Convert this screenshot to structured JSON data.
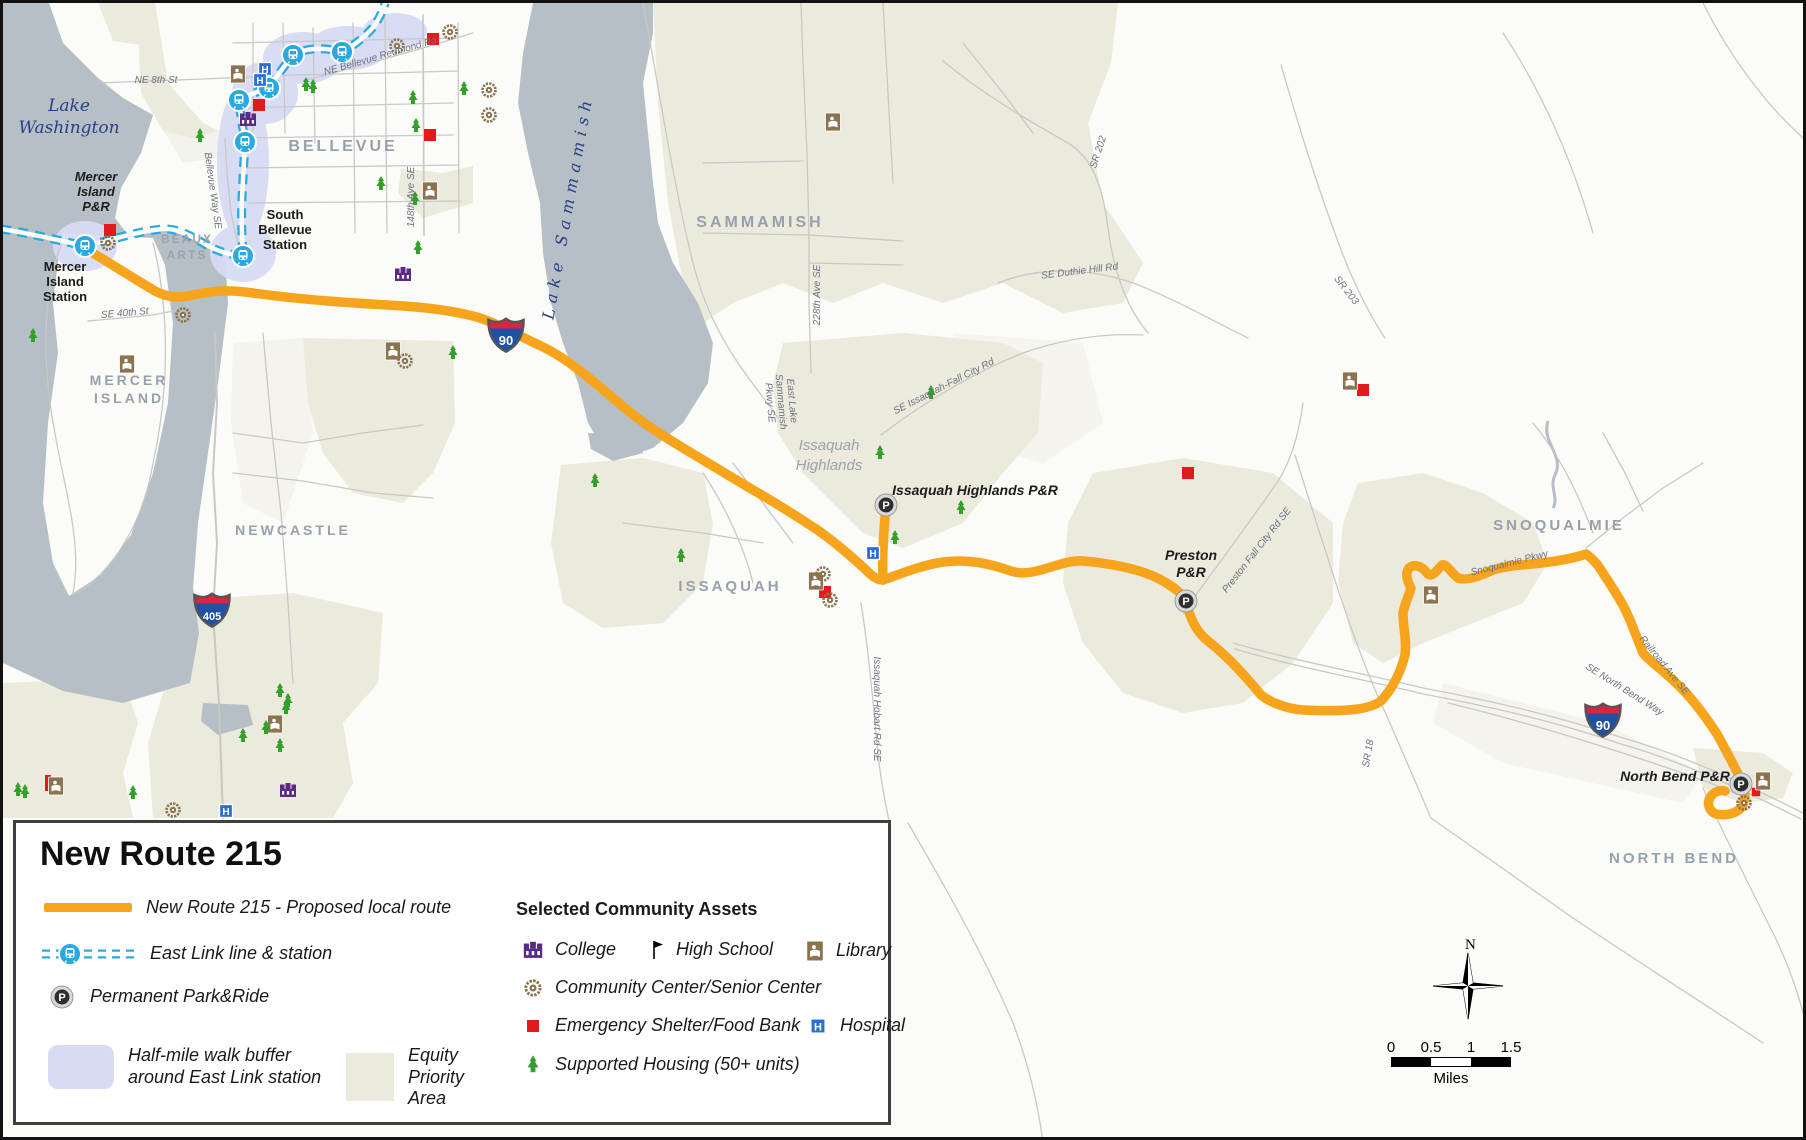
{
  "legend": {
    "title": "New Route 215",
    "route_label": "New Route 215 - Proposed local route",
    "eastlink_label": "East Link line & station",
    "parkride_label": "Permanent Park&Ride",
    "buffer_label": "Half-mile walk buffer\naround East Link station",
    "equity_label": "Equity\nPriority\nArea",
    "assets_header": "Selected Community Assets",
    "college_label": "College",
    "highschool_label": "High School",
    "library_label": "Library",
    "commcenter_label": "Community Center/Senior Center",
    "shelter_label": "Emergency Shelter/Food Bank",
    "hospital_label": "Hospital",
    "housing_label": "Supported Housing (50+ units)"
  },
  "scalebar": {
    "ticks": [
      "0",
      "0.5",
      "1",
      "1.5"
    ],
    "unit": "Miles",
    "north": "N"
  },
  "map": {
    "colors": {
      "route": "#f7a41d",
      "eastlink": "#2aa8e0",
      "water": "#b5bfc5",
      "equity": "#eceadd",
      "buffer": "#d7dbf4",
      "road": "#c8c8c4",
      "land": "#fbfbf8",
      "shield_blue": "#2051a3",
      "shield_red": "#d7263d",
      "shelter": "#e31a1c",
      "library": "#8a7450",
      "college": "#5b2a86",
      "hospital": "#2a6fd6",
      "housing": "#33a02c",
      "pnr_dark": "#2e2e2e"
    },
    "labels": [
      {
        "t": [
          "Lake",
          "Washington"
        ],
        "x": 66,
        "y": 108,
        "cls": "water",
        "fs": 17,
        "lh": 22
      },
      {
        "t": [
          "Lake Sammamish"
        ],
        "x": 570,
        "y": 205,
        "cls": "water",
        "fs": 16,
        "rot": -80,
        "ls": 6
      },
      {
        "t": [
          "BELLEVUE"
        ],
        "x": 340,
        "y": 148,
        "cls": "city",
        "fs": 16
      },
      {
        "t": [
          "SAMMAMISH"
        ],
        "x": 757,
        "y": 224,
        "cls": "city",
        "fs": 16
      },
      {
        "t": [
          "MERCER",
          "ISLAND"
        ],
        "x": 126,
        "y": 382,
        "cls": "city",
        "fs": 14,
        "lh": 18,
        "ls": 2
      },
      {
        "t": [
          "NEWCASTLE"
        ],
        "x": 290,
        "y": 532,
        "cls": "city",
        "fs": 14,
        "ls": 2
      },
      {
        "t": [
          "ISSAQUAH"
        ],
        "x": 727,
        "y": 588,
        "cls": "city",
        "fs": 15,
        "ls": 2
      },
      {
        "t": [
          "SNOQUALMIE"
        ],
        "x": 1556,
        "y": 527,
        "cls": "city",
        "fs": 15
      },
      {
        "t": [
          "NORTH BEND"
        ],
        "x": 1671,
        "y": 860,
        "cls": "city",
        "fs": 15,
        "ls": 2
      },
      {
        "t": [
          "BEAUX",
          "ARTS"
        ],
        "x": 184,
        "y": 240,
        "cls": "city-sm",
        "fs": 12,
        "lh": 16
      },
      {
        "t": [
          "Issaquah",
          "Highlands"
        ],
        "x": 826,
        "y": 447,
        "cls": "hl",
        "fs": 15,
        "lh": 20
      },
      {
        "t": [
          "Mercer",
          "Island",
          "P&R"
        ],
        "x": 93,
        "y": 178,
        "cls": "pnr",
        "fs": 13,
        "lh": 15
      },
      {
        "t": [
          "Mercer",
          "Island",
          "Station"
        ],
        "x": 62,
        "y": 268,
        "cls": "station",
        "fs": 13,
        "lh": 15
      },
      {
        "t": [
          "South",
          "Bellevue",
          "Station"
        ],
        "x": 282,
        "y": 216,
        "cls": "station",
        "fs": 13,
        "lh": 15
      },
      {
        "t": [
          "Issaquah Highlands P&R"
        ],
        "x": 972,
        "y": 492,
        "cls": "pnr",
        "fs": 14
      },
      {
        "t": [
          "Preston",
          "P&R"
        ],
        "x": 1188,
        "y": 557,
        "cls": "pnr",
        "fs": 14,
        "lh": 17
      },
      {
        "t": [
          "North Bend P&R"
        ],
        "x": 1672,
        "y": 778,
        "cls": "pnr",
        "fs": 14
      },
      {
        "t": [
          "NE 8th St"
        ],
        "x": 153,
        "y": 80,
        "cls": "road",
        "fs": 10
      },
      {
        "t": [
          "NE Bellevue Redmond Rd"
        ],
        "x": 378,
        "y": 56,
        "cls": "road",
        "fs": 10,
        "rot": -16
      },
      {
        "t": [
          "Bellevue Way SE"
        ],
        "x": 207,
        "y": 188,
        "cls": "road",
        "fs": 10,
        "rot": 82
      },
      {
        "t": [
          "148th Ave SE"
        ],
        "x": 411,
        "y": 194,
        "cls": "road",
        "fs": 10,
        "rot": -90
      },
      {
        "t": [
          "SE 40th St"
        ],
        "x": 122,
        "y": 313,
        "cls": "road",
        "fs": 10,
        "rot": -5
      },
      {
        "t": [
          "228th Ave SE"
        ],
        "x": 817,
        "y": 292,
        "cls": "road",
        "fs": 10,
        "rot": -90
      },
      {
        "t": [
          "SE Duthie Hill Rd"
        ],
        "x": 1077,
        "y": 271,
        "cls": "road",
        "fs": 10,
        "rot": -7
      },
      {
        "t": [
          "SR 202"
        ],
        "x": 1098,
        "y": 150,
        "cls": "road",
        "fs": 10,
        "rot": -72
      },
      {
        "t": [
          "SR 203"
        ],
        "x": 1341,
        "y": 289,
        "cls": "road",
        "fs": 10,
        "rot": 52
      },
      {
        "t": [
          "East Lake",
          "Sammamish",
          "Pkwy SE"
        ],
        "x": 786,
        "y": 398,
        "cls": "road",
        "fs": 10,
        "rot": 85,
        "lh": 11
      },
      {
        "t": [
          "SE Issaquah-Fall City Rd"
        ],
        "x": 942,
        "y": 386,
        "cls": "road",
        "fs": 10,
        "rot": -27
      },
      {
        "t": [
          "Issaquah Hobart Rd SE"
        ],
        "x": 871,
        "y": 706,
        "cls": "road",
        "fs": 10,
        "rot": 90
      },
      {
        "t": [
          "Preston Fall City Rd SE"
        ],
        "x": 1256,
        "y": 549,
        "cls": "road",
        "fs": 10,
        "rot": -52
      },
      {
        "t": [
          "SR 18"
        ],
        "x": 1368,
        "y": 751,
        "cls": "road",
        "fs": 10,
        "rot": -80
      },
      {
        "t": [
          "Snoqualmie Pkwy"
        ],
        "x": 1507,
        "y": 563,
        "cls": "road",
        "fs": 10,
        "rot": -14
      },
      {
        "t": [
          "Railroad Ave SE"
        ],
        "x": 1659,
        "y": 664,
        "cls": "road",
        "fs": 10,
        "rot": 51
      },
      {
        "t": [
          "SE North Bend Way"
        ],
        "x": 1620,
        "y": 689,
        "cls": "road",
        "fs": 10,
        "rot": 32
      }
    ],
    "shields": [
      {
        "num": "90",
        "x": 503,
        "y": 332
      },
      {
        "num": "90",
        "x": 1600,
        "y": 717
      },
      {
        "num": "405",
        "x": 209,
        "y": 607
      }
    ],
    "icons": [
      {
        "type": "station",
        "x": 82,
        "y": 243
      },
      {
        "type": "station",
        "x": 240,
        "y": 253
      },
      {
        "type": "station",
        "x": 242,
        "y": 139
      },
      {
        "type": "station",
        "x": 236,
        "y": 97
      },
      {
        "type": "station",
        "x": 266,
        "y": 85
      },
      {
        "type": "station",
        "x": 290,
        "y": 52
      },
      {
        "type": "station",
        "x": 339,
        "y": 49
      },
      {
        "type": "parkride",
        "x": 883,
        "y": 502
      },
      {
        "type": "parkride",
        "x": 1183,
        "y": 598
      },
      {
        "type": "parkride",
        "x": 1738,
        "y": 781
      },
      {
        "type": "hospital",
        "x": 262,
        "y": 66
      },
      {
        "type": "hospital",
        "x": 257,
        "y": 77
      },
      {
        "type": "hospital",
        "x": 870,
        "y": 550
      },
      {
        "type": "hospital",
        "x": 223,
        "y": 808
      },
      {
        "type": "shelter",
        "x": 107,
        "y": 227
      },
      {
        "type": "shelter",
        "x": 256,
        "y": 102
      },
      {
        "type": "shelter",
        "x": 430,
        "y": 36
      },
      {
        "type": "shelter",
        "x": 427,
        "y": 132
      },
      {
        "type": "shelter",
        "x": 822,
        "y": 589
      },
      {
        "type": "shelter",
        "x": 1185,
        "y": 470
      },
      {
        "type": "shelter",
        "x": 1360,
        "y": 387
      },
      {
        "type": "shelterv",
        "x": 45,
        "y": 780
      },
      {
        "type": "shelter",
        "x": 1753,
        "y": 789,
        "s": 0.7
      },
      {
        "type": "library",
        "x": 235,
        "y": 71
      },
      {
        "type": "library",
        "x": 427,
        "y": 188
      },
      {
        "type": "library",
        "x": 830,
        "y": 119
      },
      {
        "type": "library",
        "x": 124,
        "y": 361
      },
      {
        "type": "library",
        "x": 390,
        "y": 348
      },
      {
        "type": "library",
        "x": 272,
        "y": 721
      },
      {
        "type": "library",
        "x": 53,
        "y": 783
      },
      {
        "type": "library",
        "x": 813,
        "y": 578
      },
      {
        "type": "library",
        "x": 1347,
        "y": 378
      },
      {
        "type": "library",
        "x": 1428,
        "y": 592
      },
      {
        "type": "library",
        "x": 1760,
        "y": 778
      },
      {
        "type": "college",
        "x": 245,
        "y": 117
      },
      {
        "type": "college",
        "x": 400,
        "y": 272
      },
      {
        "type": "college",
        "x": 285,
        "y": 788
      },
      {
        "type": "commcenter",
        "x": 105,
        "y": 240
      },
      {
        "type": "commcenter",
        "x": 394,
        "y": 43
      },
      {
        "type": "commcenter",
        "x": 447,
        "y": 29
      },
      {
        "type": "commcenter",
        "x": 486,
        "y": 87
      },
      {
        "type": "commcenter",
        "x": 486,
        "y": 112
      },
      {
        "type": "commcenter",
        "x": 402,
        "y": 358
      },
      {
        "type": "commcenter",
        "x": 180,
        "y": 312
      },
      {
        "type": "commcenter",
        "x": 170,
        "y": 807
      },
      {
        "type": "commcenter",
        "x": 820,
        "y": 571
      },
      {
        "type": "commcenter",
        "x": 827,
        "y": 597
      },
      {
        "type": "commcenter",
        "x": 1741,
        "y": 800
      },
      {
        "type": "housing",
        "x": 197,
        "y": 133
      },
      {
        "type": "housing",
        "x": 303,
        "y": 82
      },
      {
        "type": "housing",
        "x": 310,
        "y": 84
      },
      {
        "type": "housing",
        "x": 410,
        "y": 95
      },
      {
        "type": "housing",
        "x": 413,
        "y": 123
      },
      {
        "type": "housing",
        "x": 461,
        "y": 86
      },
      {
        "type": "housing",
        "x": 415,
        "y": 245
      },
      {
        "type": "housing",
        "x": 450,
        "y": 350
      },
      {
        "type": "housing",
        "x": 378,
        "y": 181
      },
      {
        "type": "housing",
        "x": 412,
        "y": 196
      },
      {
        "type": "housing",
        "x": 592,
        "y": 478
      },
      {
        "type": "housing",
        "x": 678,
        "y": 553
      },
      {
        "type": "housing",
        "x": 877,
        "y": 450
      },
      {
        "type": "housing",
        "x": 928,
        "y": 390
      },
      {
        "type": "housing",
        "x": 958,
        "y": 505
      },
      {
        "type": "housing",
        "x": 892,
        "y": 535
      },
      {
        "type": "housing",
        "x": 240,
        "y": 733
      },
      {
        "type": "housing",
        "x": 263,
        "y": 725
      },
      {
        "type": "housing",
        "x": 277,
        "y": 688
      },
      {
        "type": "housing",
        "x": 285,
        "y": 698
      },
      {
        "type": "housing",
        "x": 283,
        "y": 705
      },
      {
        "type": "housing",
        "x": 277,
        "y": 743
      },
      {
        "type": "housing",
        "x": 130,
        "y": 790
      },
      {
        "type": "housing",
        "x": 15,
        "y": 787
      },
      {
        "type": "housing",
        "x": 22,
        "y": 789
      },
      {
        "type": "housing",
        "x": 30,
        "y": 333
      }
    ]
  }
}
